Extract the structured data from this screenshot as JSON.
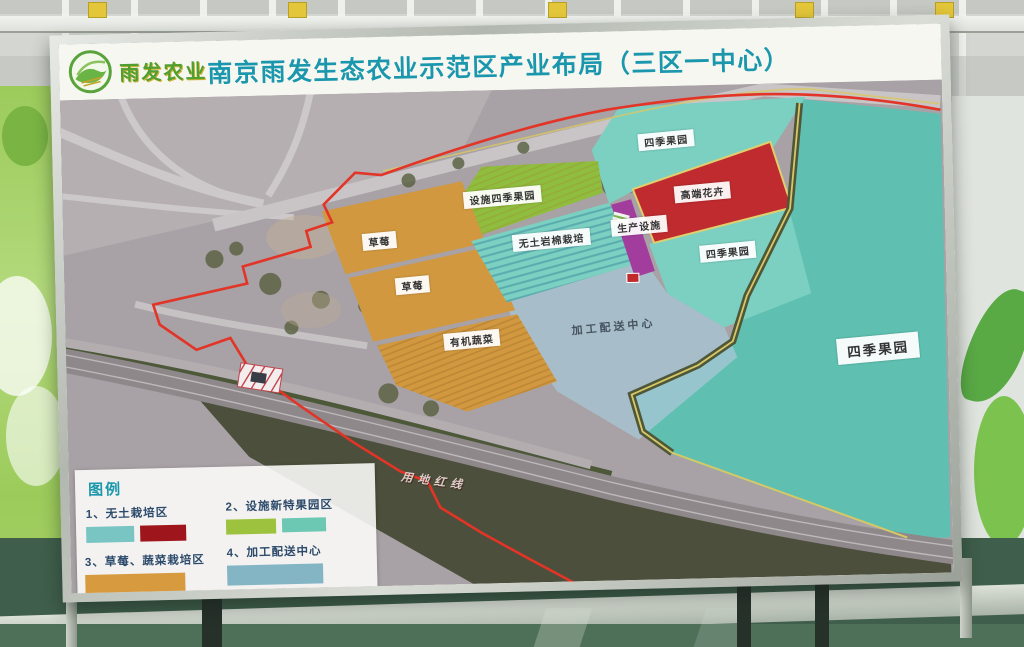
{
  "sign": {
    "logo_text": "雨发农业",
    "title": "南京雨发生态农业示范区产业布局（三区一中心）"
  },
  "legend": {
    "title": "图例",
    "items": [
      {
        "label": "1、无土栽培区",
        "swatches": [
          "#79c5c3",
          "#9e151c"
        ]
      },
      {
        "label": "2、设施新特果园区",
        "swatches": [
          "#9dc23d",
          "#6cc8b3"
        ]
      },
      {
        "label": "3、草莓、蔬菜栽培区",
        "swatches": [
          "#d79a3f"
        ]
      },
      {
        "label": "4、加工配送中心",
        "swatches": [
          "#84b5c5"
        ]
      }
    ]
  },
  "map": {
    "labels": {
      "caomei1": "草莓",
      "caomei2": "草莓",
      "youji": "有机蔬菜",
      "sheshi": "设施四季果园",
      "wutu": "无土岩棉栽培",
      "shengchan": "生产设施",
      "gaoduan": "高端花卉",
      "siji_top": "四季果园",
      "siji_mid": "四季果园",
      "siji_big": "四季果园",
      "jiagong": "加工配送中心",
      "hongxian": "用地红线"
    }
  },
  "colors": {
    "title_teal": "#1b97ad",
    "logo_green": "#4f9f33",
    "big_cyan": "#5fc0b1",
    "cyan_parcel": "#7bd0c2",
    "green_parcel": "#8fbe3e",
    "orange": "#d1983f",
    "red_parcel": "#bf2b2e",
    "purple": "#a23d9e",
    "light_blue": "#a6c6d5",
    "red_line": "#e23427",
    "yellow_line": "#d8c766"
  }
}
